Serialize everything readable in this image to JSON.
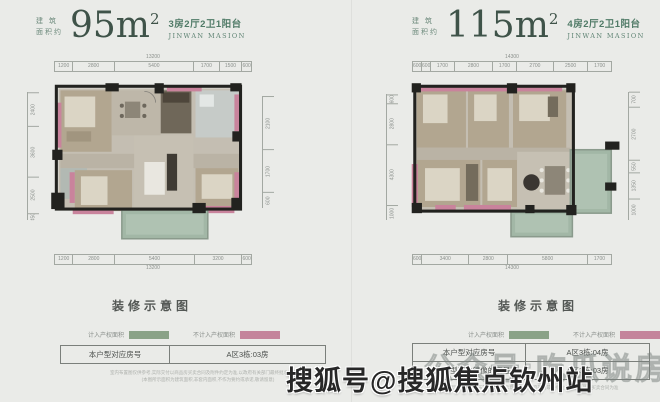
{
  "watermark": {
    "faint": "公众号:吃瓜说房",
    "bold": "搜狐号@搜狐焦点钦州站"
  },
  "units": [
    {
      "area_label_line1": "建 筑",
      "area_label_line2": "面积约",
      "area_value": "95m",
      "area_sup": "2",
      "spec": "3房2厅2卫1阳台",
      "brand": "JINWAN MASION",
      "dims": {
        "top_total": "13200",
        "top": [
          "1200",
          "2800",
          "5400",
          "1700",
          "1500",
          "600"
        ],
        "bottom": [
          "1200",
          "2800",
          "5400",
          "3200",
          "600"
        ],
        "bottom_total": "13200",
        "left": [
          "2400",
          "3600",
          "2500",
          "450"
        ],
        "right": [
          "2100",
          "1700",
          "600"
        ]
      },
      "deco_title": "装修示意图",
      "legend": [
        {
          "label": "计入产权面积",
          "color": "#8aa287"
        },
        {
          "label": "不计入产权面积",
          "color": "#c4849b"
        }
      ],
      "table": [
        {
          "label": "本户型对应房号",
          "value": "A区3栋:03房"
        }
      ],
      "disclaimer_line1": "室内布置图仅供参考,实际交付以商品房买卖合同及附件约定为准,以政府有关部门最终批准文件为准",
      "disclaimer_line2": "(本图所示面积为建筑面积,非套内面积,不作为要约或承诺,敬请留意)"
    },
    {
      "area_label_line1": "建 筑",
      "area_label_line2": "面积约",
      "area_value": "115m",
      "area_sup": "2",
      "spec": "4房2厅2卫1阳台",
      "brand": "JINWAN MASION",
      "dims": {
        "top_total": "14300",
        "top": [
          "600",
          "600",
          "1700",
          "2800",
          "1700",
          "2700",
          "2500",
          "1700"
        ],
        "bottom": [
          "600",
          "3400",
          "2800",
          "5800",
          "1700"
        ],
        "bottom_total": "14300",
        "left": [
          "600",
          "2800",
          "4300",
          "1000"
        ],
        "right": [
          "700",
          "2700",
          "550",
          "1350",
          "1000"
        ]
      },
      "deco_title": "装修示意图",
      "legend": [
        {
          "label": "计入产权面积",
          "color": "#8aa287"
        },
        {
          "label": "不计入产权面积",
          "color": "#c4849b"
        }
      ],
      "table": [
        {
          "label": "本户型对应房号",
          "value": "A区3栋:04房"
        },
        {
          "label": "与本户型互为镜像的房号",
          "value": "A区3栋:03房"
        }
      ],
      "disclaimer_line1": "本户型图所示家具布置仅为装修示意,具体以政府部门最终批准文件及商品房买卖合同为准",
      "disclaimer_line2": ""
    }
  ]
}
